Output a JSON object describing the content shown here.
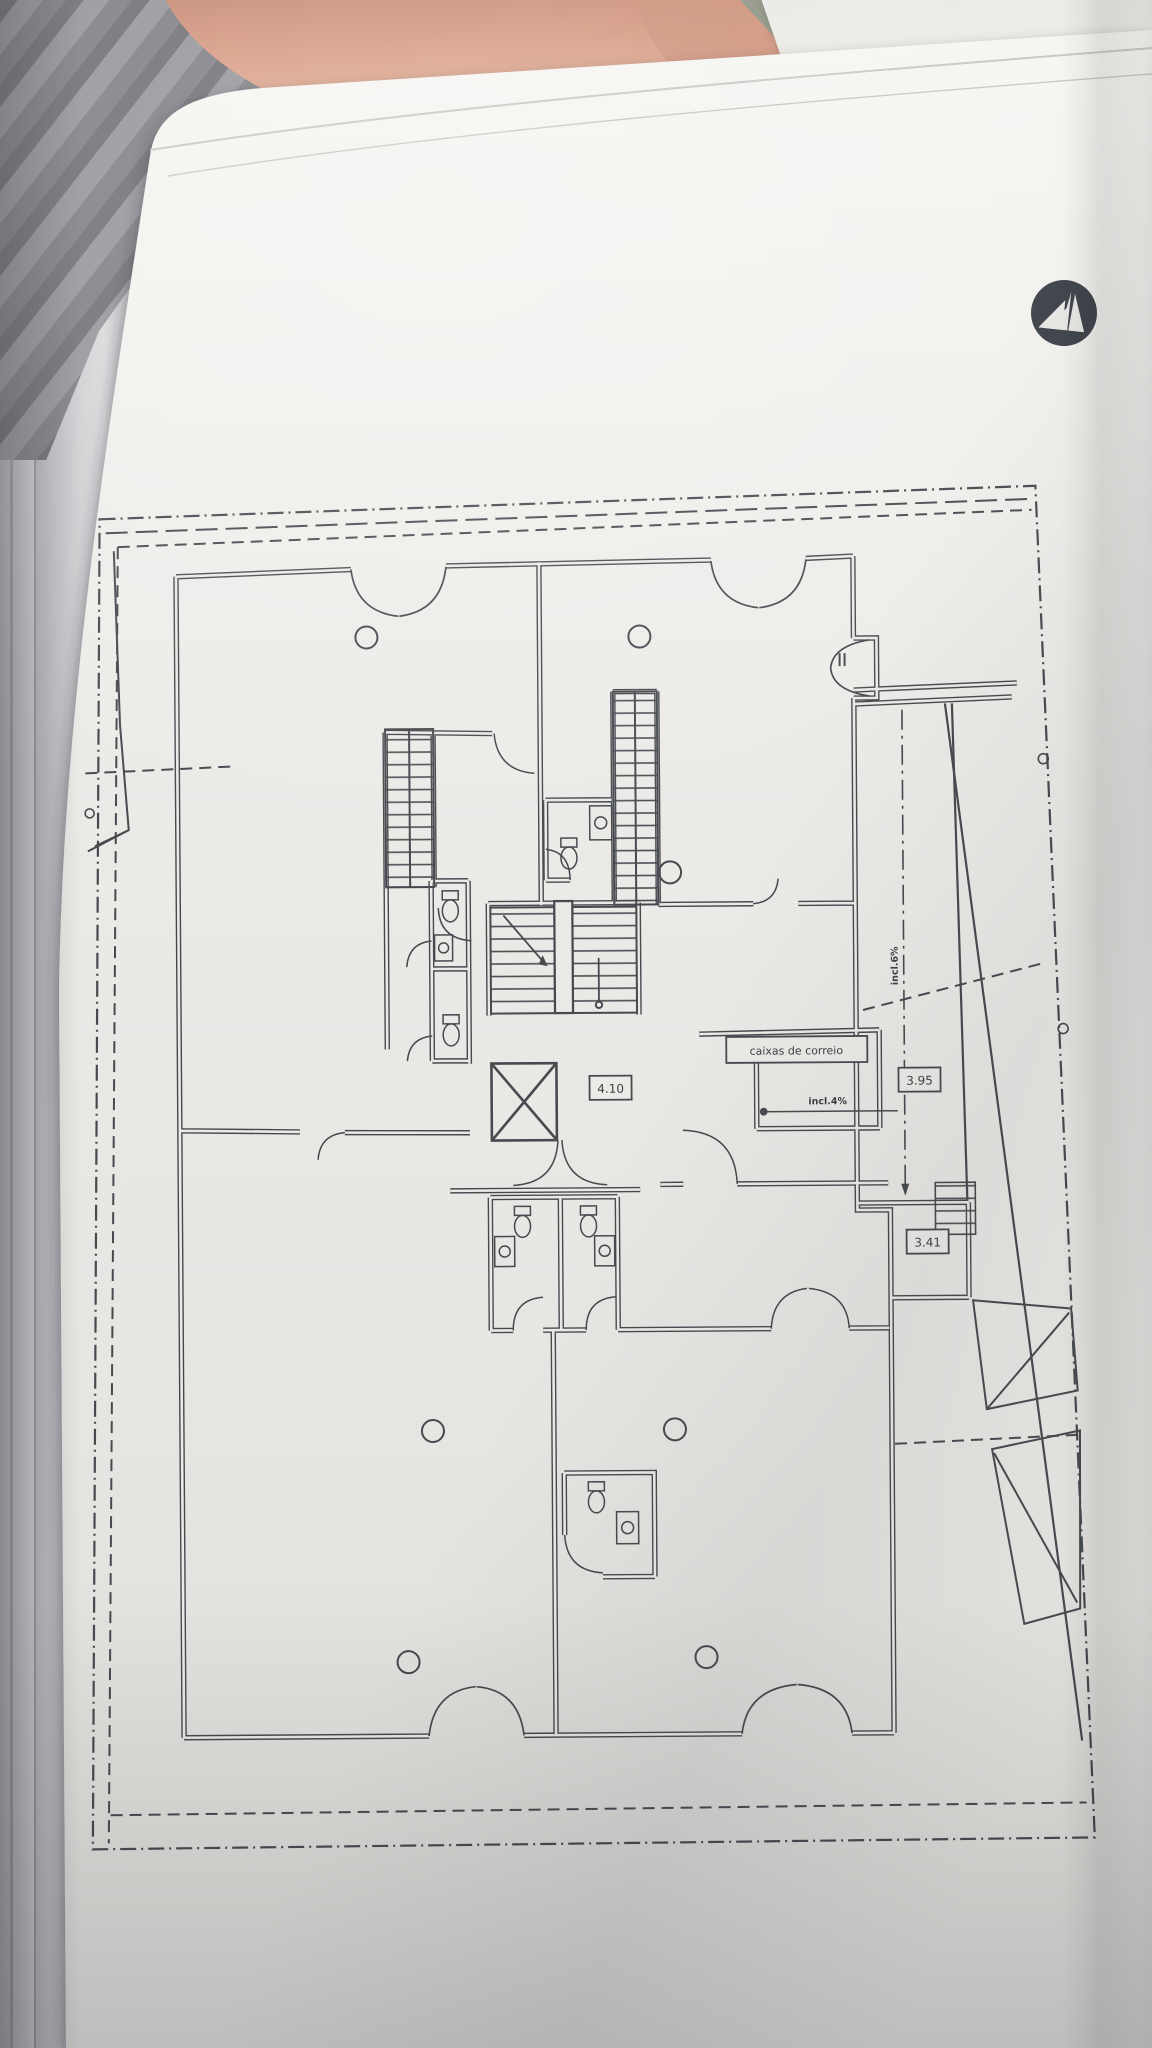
{
  "plan": {
    "labels": {
      "mailboxes": "caixas de correio",
      "dim_core": "4.10",
      "dim_ramp": "3.95",
      "dim_lower": "3.41",
      "slope_entry": "incl.4%",
      "slope_ramp": "incl.6%"
    },
    "icons": {
      "logo": "triangle-monogram-logo",
      "elevator": "elevator-x-box",
      "stairs": "stair-treads",
      "columns": "column-circles"
    },
    "colors": {
      "paper": "#eceae7",
      "ink": "#44484d",
      "background": "#a6a6aa",
      "leather": "#cd8d74",
      "olive": "#8e9383"
    }
  },
  "underlying_sheet": {
    "number": "25"
  }
}
